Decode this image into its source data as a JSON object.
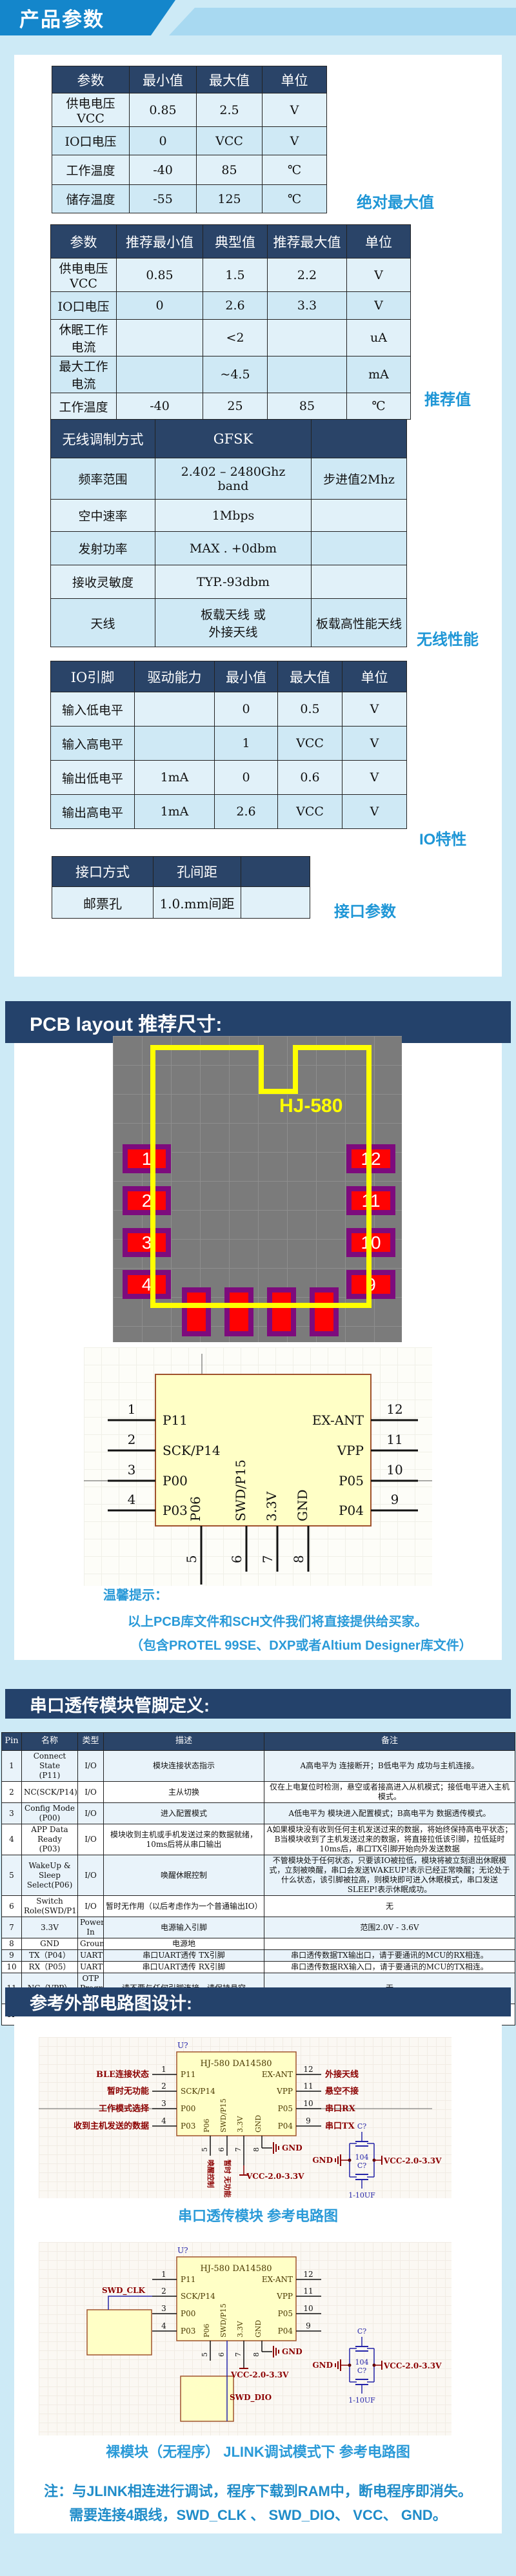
{
  "banner": {
    "title": "产品参数"
  },
  "sections": {
    "pcb_title": "PCB layout 推荐尺寸:",
    "pins_title": "串口透传模块管脚定义:",
    "circuit_title": "参考外部电路图设计:"
  },
  "colors": {
    "banner_blue": "#1486cb",
    "banner_light": "#a8d9f1",
    "navy_header": "#2a4468",
    "accent_blue": "#1e96d6",
    "row_light": "#e1f1f9",
    "row_dark": "#cfe9f5",
    "pcb_yellow": "#ffff00",
    "pad_red": "#ff0202",
    "pad_purple": "#7d0b7d"
  },
  "abs_max": {
    "label": "绝对最大值",
    "headers": [
      "参数",
      "最小值",
      "最大值",
      "单位"
    ],
    "rows": [
      [
        "供电电压\nVCC",
        "0.85",
        "2.5",
        "V"
      ],
      [
        "IO口电压",
        "0",
        "VCC",
        "V"
      ],
      [
        "工作温度",
        "-40",
        "85",
        "℃"
      ],
      [
        "储存温度",
        "-55",
        "125",
        "℃"
      ]
    ]
  },
  "recommend": {
    "label": "推荐值",
    "headers": [
      "参数",
      "推荐最小值",
      "典型值",
      "推荐最大值",
      "单位"
    ],
    "rows": [
      [
        "供电电压\nVCC",
        "0.85",
        "1.5",
        "2.2",
        "V"
      ],
      [
        "IO口电压",
        "0",
        "2.6",
        "3.3",
        "V"
      ],
      [
        "休眠工作\n电流",
        "",
        "<2",
        "",
        "uA"
      ],
      [
        "最大工作\n电流",
        "",
        "~4.5",
        "",
        "mA"
      ],
      [
        "工作温度",
        "-40",
        "25",
        "85",
        "℃"
      ]
    ]
  },
  "wireless": {
    "label": "无线性能",
    "headers": [
      "无线调制方式",
      "GFSK",
      ""
    ],
    "rows": [
      [
        "频率范围",
        "2.402 – 2480Ghz\nband",
        "步进值2Mhz"
      ],
      [
        "空中速率",
        "1Mbps",
        ""
      ],
      [
        "发射功率",
        "MAX . +0dbm",
        ""
      ],
      [
        "接收灵敏度",
        "TYP.-93dbm",
        ""
      ],
      [
        "天线",
        "板载天线  或\n外接天线",
        "板载高性能天线"
      ]
    ]
  },
  "io": {
    "label": "IO特性",
    "headers": [
      "IO引脚",
      "驱动能力",
      "最小值",
      "最大值",
      "单位"
    ],
    "rows": [
      [
        "输入低电平",
        "",
        "0",
        "0.5",
        "V"
      ],
      [
        "输入高电平",
        "",
        "1",
        "VCC",
        "V"
      ],
      [
        "输出低电平",
        "1mA",
        "0",
        "0.6",
        "V"
      ],
      [
        "输出高电平",
        "1mA",
        "2.6",
        "VCC",
        "V"
      ]
    ]
  },
  "interface": {
    "label": "接口参数",
    "headers": [
      "接口方式",
      "孔间距",
      ""
    ],
    "rows": [
      [
        "邮票孔",
        "1.0.mm间距",
        ""
      ]
    ]
  },
  "pcb": {
    "model": "HJ-580",
    "left_pads": [
      "1",
      "2",
      "3",
      "4"
    ],
    "right_pads": [
      "12",
      "11",
      "10",
      "9"
    ]
  },
  "chip": {
    "ref": "U?",
    "title": "HJ-580 DA14580",
    "left": [
      {
        "n": "1",
        "name": "P11"
      },
      {
        "n": "2",
        "name": "SCK/P14"
      },
      {
        "n": "3",
        "name": "P00"
      },
      {
        "n": "4",
        "name": "P03"
      }
    ],
    "right": [
      {
        "n": "12",
        "name": "EX-ANT"
      },
      {
        "n": "11",
        "name": "VPP"
      },
      {
        "n": "10",
        "name": "P05"
      },
      {
        "n": "9",
        "name": "P04"
      }
    ],
    "bottom": [
      {
        "n": "5",
        "name": "P06"
      },
      {
        "n": "6",
        "name": "SWD/P15"
      },
      {
        "n": "7",
        "name": "3.3V"
      },
      {
        "n": "8",
        "name": "GND"
      }
    ]
  },
  "tips": {
    "title": "温馨提示：",
    "line1": "以上PCB库文件和SCH文件我们将直接提供给买家。",
    "line2": "（包含PROTEL 99SE、DXP或者Altium Designer库文件）"
  },
  "pin_table": {
    "headers": [
      "Pin",
      "名称",
      "类型",
      "描述",
      "备注"
    ],
    "rows": [
      [
        "1",
        "Connect State\n(P11)",
        "I/O",
        "模块连接状态指示",
        "A高电平为  连接断开；B低电平为  成功与主机连接。"
      ],
      [
        "2",
        "NC(SCK/P14)",
        "I/O",
        "主从切换",
        "仅在上电复位时检测，悬空或者接高进入从机模式；接低电平进入主机模式。"
      ],
      [
        "3",
        "Config Mode\n(P00)",
        "I/O",
        "进入配置模式",
        "A低电平为  模块进入配置模式；B高电平为  数据透传模式。"
      ],
      [
        "4",
        "APP Data Ready\n(P03)",
        "I/O",
        "模块收到主机或手机发送过来的数据就绪，10ms后将从串口输出",
        "A如果模块没有收到任何主机发送过来的数据，将始终保持高电平状态；B当模块收到了主机发送过来的数据，将直接拉低该引脚，拉低延时10ms后，串口TX引脚开始向外发送数据"
      ],
      [
        "5",
        "WakeUp & Sleep\nSelect(P06)",
        "I/O",
        "唤醒休眠控制",
        "不管模块处于任何状态，只要该IO被拉低，模块将被立刻退出休眠模式，立刻被唤醒，串口会发送WAKEUP!表示已经正常唤醒；无论处于什么状态，该引脚被拉高，则模块即可进入休眠模式，串口发送SLEEP!表示休眠成功。"
      ],
      [
        "6",
        "Switch\nRole(SWD/P15)",
        "I/O",
        "暂时无作用（以后考虑作为一个普通输出IO）",
        "无"
      ],
      [
        "7",
        "3.3V",
        "Power\nIn",
        "电源输入引脚",
        "范围2.0V - 3.6V"
      ],
      [
        "8",
        "GND",
        "Ground",
        "电源地",
        ""
      ],
      [
        "9",
        "TX（P04）",
        "UART",
        "串口UART透传   TX引脚",
        "串口透传数据TX输出口，请于要通讯的MCU的RX相连。"
      ],
      [
        "10",
        "RX（P05）",
        "UART",
        "串口UART透传   RX引脚",
        "串口透传数据RX输入口，请于要通讯的MCU的TX相连。"
      ],
      [
        "11",
        "NC（VPP）",
        "OTP\nProgram\nPower",
        "请不要与任何引脚连接，请保持悬空",
        "无"
      ],
      [
        "12",
        "EX-ANT",
        "RF  out",
        "外接天线射频输出",
        "提供外接天线接口使用.(外接天线可以使得通信距离变得更加远且可靠！)"
      ]
    ]
  },
  "circuit1": {
    "left_labels": [
      "BLE连接状态",
      "暂时无功能",
      "工作模式选择",
      "收到主机发送的数据"
    ],
    "right_labels": [
      "外接天线",
      "悬空不接",
      "串口RX",
      "串口TX"
    ],
    "pin5_label": "唤醒控制",
    "pin6_label": "暂时 无功能",
    "vcc": "VCC-2.0-3.3V",
    "gnd": "GND",
    "caption": "串口透传模块 参考电路图"
  },
  "cap_net": {
    "ref1": "C?",
    "val1": "104",
    "ref2": "C?",
    "val2": "1-10UF",
    "gnd": "GND",
    "vcc": "VCC-2.0-3.3V"
  },
  "circuit2": {
    "swd_clk": "SWD_CLK",
    "swd_dio": "SWD_DIO",
    "vcc": "VCC-2.0-3.3V",
    "gnd": "GND",
    "caption": "裸模块（无程序） JLINK调试模式下 参考电路图"
  },
  "note": {
    "line1": "注：与JLINK相连进行调试，程序下载到RAM中，断电程序即消失。",
    "line2": "需要连接4跟线，SWD_CLK 、 SWD_DIO、 VCC、 GND。"
  }
}
